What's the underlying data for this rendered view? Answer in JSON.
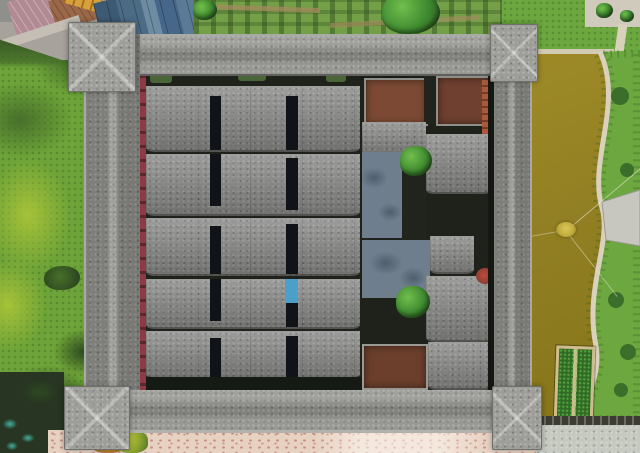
{
  "scene": {
    "type": "aerial-photograph",
    "camera": "nadir straight-down drone view",
    "subject": "Large square walled heritage compound with gray tiled roofs, four protruding corner watchtowers, parallel rows of terraced dwellings on the west side and courtyard halls on the east side",
    "setting": "Lawn and a dark drainage stream to the west, village houses with blue metal roofs and a vegetable garden to the north, an olive-green fish pond with a curving stone walkway to the east, pink-speckled pavement to the south",
    "lighting": "overcast daylight, muted tones"
  },
  "regions": {
    "west-lawn": "Bright green lawn strip along the west side with lime patches and dark shrubs",
    "drainage-stream": "Dark overgrown stream in the southwest corner with teal water glints",
    "village-block": "Village rooftops northwest of the compound seen obliquely",
    "village-mauve-roof": "Pink-mauve tiled roof",
    "village-rust-roof": "Rust-brown tiled roof",
    "yellow-ladder-truck": "Long yellow ladder-like object on the lane",
    "blue-metal-roofs": "Cluster of blue-gray metal roof panels",
    "vegetable-garden": "Hedged vegetable plots north of the wall",
    "garden-tree-large": "Large dark tree crown in the garden",
    "northeast-lawn": "Lawn with light footpaths northeast of the compound",
    "lakeside-plaza": "Light paved plaza at top right with small trees",
    "pond": "Olive-brown fish pond along the east side",
    "shore-grass": "Grass bank east of the pond",
    "shore-path": "Light S-curved stone walkway following the shoreline",
    "viewing-platform": "Gray paved viewing platform jutting toward the pond",
    "aerator-float": "Small yellow floating aerator with mooring ropes",
    "planting-raft": "Rectangular floating raft with two rows of green plants",
    "pond-revetment": "Dark stone revetment along the south edge of the pond",
    "south-pavement-pale": "Pale gray pavement at the southeast",
    "south-pavement-pink": "Pink-speckled pavement south of the wall",
    "south-bush": "Yellow-green bush by the south pavement",
    "perimeter-wall": "Gray granite-speckled tiled roof of the enclosing wall",
    "corner-towers": "Four hip-roofed watchtowers protruding at the corners",
    "red-inner-walkway": "Narrow red-painted walkway along the inner west wall",
    "roof-rows": "Five parallel rows of gray tiled dwelling roofs",
    "roof-slots": "Black courtyard light-well slots between roof columns",
    "blue-tarp": "Small bright blue tarp in one light-well",
    "red-courtyards": "Red-brown earth courtyards in the northeast quarter",
    "stone-courtyards": "Blue-gray stone paved courtyards",
    "courtyard-trees": "Two round green trees inside the east courtyards",
    "hall-roofs": "Gray tiled roofs of the central ancestral halls",
    "brick-building": "Orange exposed-brick building against the inner east wall",
    "flower-bush": "Small red flowering shrub near the east wall",
    "earth-courtyard-south": "Brown earth courtyard in the southeast quarter"
  },
  "colors": {
    "wall-granite": "#8f8f8b",
    "wall-granite-light": "#9d9d99",
    "roof-granite": "#8a8a88",
    "alley-dark": "#1e221a",
    "slot-black": "#101418",
    "red-walkway": "#8d3a45",
    "grass-base": "#6da338",
    "grass-lime": "#a6c238",
    "grass-dark": "#47702b",
    "bush-dark": "#2e481f",
    "garden-green": "#73a046",
    "garden-path": "#a08a5c",
    "lawn-east": "#6ca73f",
    "tree-green": "#3f8a30",
    "tree-light": "#70bf4d",
    "pond-olive": "#938024",
    "pond-deep": "#857419",
    "shore-path": "#d9d1bc",
    "platform-gray": "#c7c7c0",
    "raft-frame": "#cdbd8e",
    "raft-plants": "#2f6b24",
    "float-yellow": "#c2ae3e",
    "courtyard-red": "#7c4a34",
    "courtyard-red-east": "#6f4030",
    "courtyard-brown": "#6b3f2c",
    "court-blue": "#6e7e8c",
    "court-blue-dark": "#4e5e6e",
    "brick-orange": "#a85a3a",
    "tarp-blue": "#4aa0c8",
    "pave-pink": "#e7d2c2",
    "pave-speck": "#c98f86",
    "pave-pale": "#c6c9c0",
    "stream-dark": "#273522",
    "stream-teal": "#43b0a0",
    "metal-blue": "#4c6c86",
    "metal-blue-light": "#6d8ca2",
    "roof-mauve": "#b28a94",
    "roof-rust": "#9a6848",
    "truck-yellow": "#d8a03c",
    "building-gray": "#a8a29c",
    "flower-red": "#c04a3a",
    "moss-green": "#4a6638"
  }
}
